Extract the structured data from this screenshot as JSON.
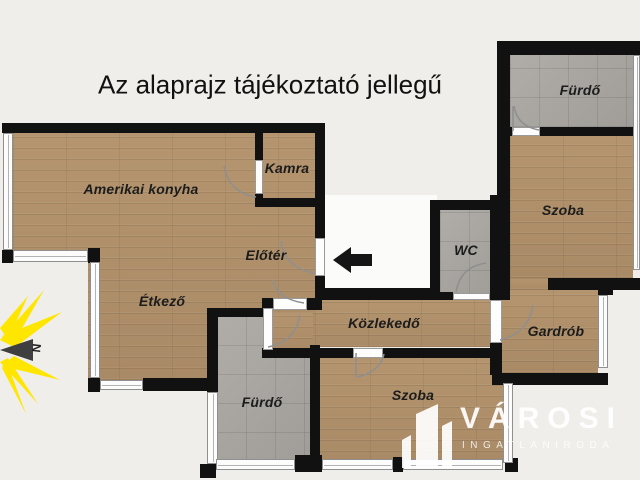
{
  "title": "Az alaprajz tájékoztató jellegű",
  "compass": {
    "north_label": "N"
  },
  "rooms": {
    "kitchen": "Amerikai konyha",
    "pantry": "Kamra",
    "entry_hall": "Előtér",
    "dining": "Étkező",
    "corridor": "Közlekedő",
    "wc": "WC",
    "bath_bottom": "Fürdő",
    "room_bottom": "Szoba",
    "wardrobe": "Gardrób",
    "room_right": "Szoba",
    "bath_top": "Fürdő"
  },
  "watermark": {
    "brand": "VÁROSI",
    "tagline": "INGATLANIRODA"
  },
  "colors": {
    "bg": "#f0eeea",
    "wall": "#111111",
    "wood": "#b1916c",
    "tile": "#a8a5a0",
    "window": "#fcfcfc",
    "inset": "#fbfbfa",
    "sun": "#ffe600",
    "arrow": "#151515",
    "watermark": "#ffffff"
  }
}
